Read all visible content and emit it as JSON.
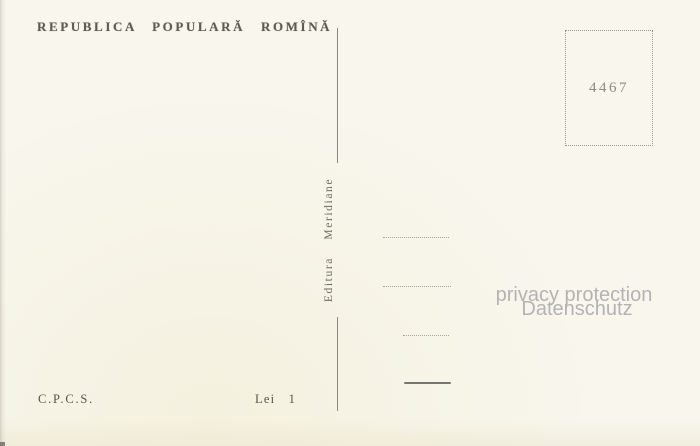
{
  "header": {
    "country": "REPUBLICA POPULARĂ ROMÎNĂ"
  },
  "stamp_box": {
    "number": "4467"
  },
  "divider": {
    "publisher": "Editura Meridiane"
  },
  "watermark": {
    "line1": "privacy protection",
    "line2": "Datenschutz"
  },
  "footer": {
    "agency": "C.P.C.S.",
    "price": "Lei 1"
  },
  "colors": {
    "paper": "#f8f6ed",
    "ink": "#5e5c52",
    "line": "#8b897f",
    "watermark": "#b3b3b3"
  }
}
